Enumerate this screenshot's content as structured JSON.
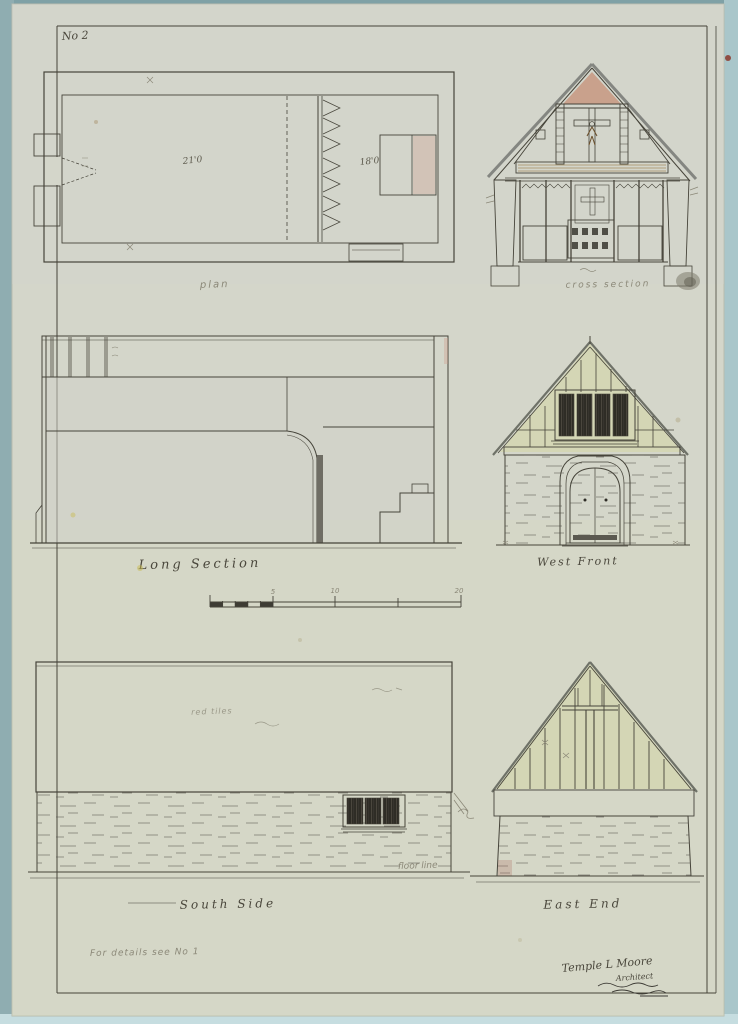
{
  "sheet": {
    "number": "No 2",
    "footnote": "For details see No 1"
  },
  "captions": {
    "plan": "plan",
    "cross_section": "cross section",
    "long_section": "Long Section",
    "west_front": "West Front",
    "south_side": "South Side",
    "east_end": "East End"
  },
  "annotations": {
    "nave_length": "21'0",
    "chancel_length": "18'0",
    "floor_line": "floor line",
    "roof_material": "red tiles",
    "scale_5": "5",
    "scale_10": "10",
    "scale_20": "20"
  },
  "signature": {
    "name": "Temple L Moore",
    "role": "Architect"
  },
  "palette": {
    "mat": "#9db9bc",
    "paper": "#d4d6ca",
    "ink": "#46443a",
    "pencil": "#8b8878",
    "wash_green": "#d5d6b8",
    "wash_stone": "#ced1ab",
    "wash_gray": "#a6a6a0",
    "wood": "#c7a05e",
    "roof_red": "#c39384",
    "glazing": "#2e2c25"
  }
}
